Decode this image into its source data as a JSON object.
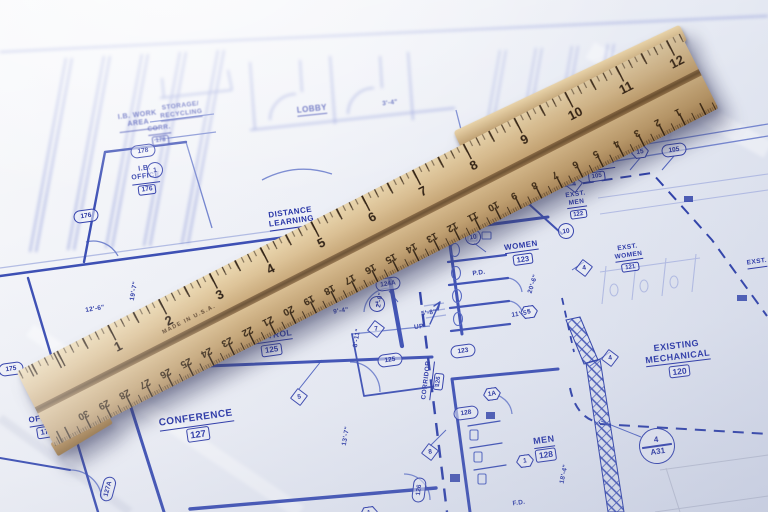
{
  "colors": {
    "paper": "#eef0f7",
    "ink": "#3b4eb4",
    "ink_dark": "#2531a0",
    "wood": "#d0b183",
    "tick": "#33220f"
  },
  "ruler": {
    "inch_numbers": [
      "1",
      "2",
      "3",
      "4",
      "5",
      "6",
      "7",
      "8",
      "9",
      "10",
      "11",
      "12"
    ],
    "cm_numbers": [
      "30",
      "29",
      "28",
      "27",
      "26",
      "25",
      "24",
      "23",
      "22",
      "21",
      "20",
      "19",
      "18",
      "17",
      "16",
      "15",
      "14",
      "13",
      "12",
      "11",
      "10",
      "9",
      "8",
      "7",
      "6",
      "5",
      "4",
      "3",
      "2",
      "1"
    ],
    "brand_text": "MADE IN U.S.A."
  },
  "blueprint": {
    "rooms": [
      {
        "name": "I.B. WORK\nAREA",
        "num": "",
        "x": 138,
        "y": 121,
        "rot": -7,
        "size": 7
      },
      {
        "name": "STORAGE/\nRECYCLING",
        "num": "",
        "x": 181,
        "y": 111,
        "rot": -7,
        "size": 6.5
      },
      {
        "name": "CORR.",
        "num": "178",
        "x": 160,
        "y": 135,
        "rot": -7,
        "size": 6.5
      },
      {
        "name": "I.B.\nOFFICE",
        "num": "176",
        "x": 146,
        "y": 180,
        "rot": -7,
        "size": 7
      },
      {
        "name": "LOBBY",
        "num": "",
        "x": 312,
        "y": 110,
        "rot": -6,
        "size": 8
      },
      {
        "name": "COATS/\nVEND.",
        "num": "",
        "x": 492,
        "y": 141,
        "rot": -8,
        "size": 6.5
      },
      {
        "name": "DISTANCE\nLEARNING",
        "num": "",
        "x": 291,
        "y": 218,
        "rot": -8,
        "size": 8
      },
      {
        "name": "VIDEO\nCONTROL",
        "num": "125",
        "x": 270,
        "y": 338,
        "rot": -8,
        "size": 8.5
      },
      {
        "name": "CONFERENCE",
        "num": "127",
        "x": 197,
        "y": 427,
        "rot": -8,
        "size": 10
      },
      {
        "name": "I.S.\nOFFICE",
        "num": "175",
        "x": 45,
        "y": 421,
        "rot": -9,
        "size": 8
      },
      {
        "name": "CORRIDOR",
        "num": "105",
        "x": 596,
        "y": 171,
        "rot": -8,
        "size": 6.5
      },
      {
        "name": "EXST.\nMEN",
        "num": "122",
        "x": 577,
        "y": 205,
        "rot": -8,
        "size": 6.5
      },
      {
        "name": "EXST.\nWOMEN",
        "num": "121",
        "x": 629,
        "y": 258,
        "rot": -8,
        "size": 6.5
      },
      {
        "name": "WOMEN",
        "num": "123",
        "x": 522,
        "y": 253,
        "rot": -8,
        "size": 8
      },
      {
        "name": "MEN",
        "num": "128",
        "x": 545,
        "y": 448,
        "rot": -8,
        "size": 9
      },
      {
        "name": "CORRIDOR",
        "num": "126",
        "x": 433,
        "y": 381,
        "rot": -83,
        "size": 6.5
      },
      {
        "name": "EXISTING\nMECHANICAL",
        "num": "120",
        "x": 678,
        "y": 359,
        "rot": -7,
        "size": 9
      },
      {
        "name": "EXST.",
        "num": "",
        "x": 757,
        "y": 263,
        "rot": -8,
        "size": 6.5
      }
    ],
    "tags": [
      {
        "shape": "oval",
        "text": "175",
        "x": 11,
        "y": 369,
        "rot": -8
      },
      {
        "shape": "oval",
        "text": "176",
        "x": 86,
        "y": 216,
        "rot": -8
      },
      {
        "shape": "oval",
        "text": "178",
        "x": 143,
        "y": 151,
        "rot": -8
      },
      {
        "shape": "oval",
        "text": "124A",
        "x": 388,
        "y": 284,
        "rot": -8
      },
      {
        "shape": "oval",
        "text": "125",
        "x": 390,
        "y": 360,
        "rot": -8
      },
      {
        "shape": "oval",
        "text": "123",
        "x": 463,
        "y": 351,
        "rot": -8
      },
      {
        "shape": "oval",
        "text": "128",
        "x": 466,
        "y": 413,
        "rot": -8
      },
      {
        "shape": "oval",
        "text": "126",
        "x": 419,
        "y": 490,
        "rot": -83
      },
      {
        "shape": "oval",
        "text": "127A",
        "x": 108,
        "y": 489,
        "rot": -75
      },
      {
        "shape": "oval",
        "text": "105",
        "x": 674,
        "y": 150,
        "rot": -8
      },
      {
        "shape": "hex",
        "text": "15",
        "x": 640,
        "y": 152,
        "rot": -8
      },
      {
        "shape": "hex",
        "text": "5",
        "x": 529,
        "y": 299,
        "rot": -8
      },
      {
        "shape": "hex",
        "text": "1A",
        "x": 492,
        "y": 368,
        "rot": -8
      },
      {
        "shape": "hex",
        "text": "1A",
        "x": 294,
        "y": 486,
        "rot": -8
      },
      {
        "shape": "hex",
        "text": "1",
        "x": 369,
        "y": 461,
        "rot": -8
      },
      {
        "shape": "hex",
        "text": "1",
        "x": 525,
        "y": 396,
        "rot": -8
      },
      {
        "shape": "circle",
        "text": "1",
        "x": 146,
        "y": 390,
        "rot": -8
      },
      {
        "shape": "circle",
        "text": "1",
        "x": 155,
        "y": 170,
        "rot": -8
      },
      {
        "shape": "circle",
        "text": "7",
        "x": 377,
        "y": 304,
        "rot": -8
      },
      {
        "shape": "circle",
        "text": "10",
        "x": 473,
        "y": 237,
        "rot": -8
      },
      {
        "shape": "circle",
        "text": "10",
        "x": 566,
        "y": 231,
        "rot": -8
      },
      {
        "shape": "diamond",
        "text": "7",
        "x": 376,
        "y": 329,
        "rot": -8
      },
      {
        "shape": "diamond",
        "text": "5",
        "x": 299,
        "y": 397,
        "rot": -8
      },
      {
        "shape": "diamond",
        "text": "8",
        "x": 430,
        "y": 452,
        "rot": -8
      },
      {
        "shape": "diamond",
        "text": "4",
        "x": 574,
        "y": 184,
        "rot": -8
      },
      {
        "shape": "diamond",
        "text": "4",
        "x": 584,
        "y": 268,
        "rot": -8
      },
      {
        "shape": "diamond",
        "text": "4",
        "x": 610,
        "y": 358,
        "rot": -8
      }
    ],
    "dims": [
      {
        "text": "12'-6\"",
        "x": 95,
        "y": 309,
        "rot": -9
      },
      {
        "text": "19'-7\"",
        "x": 134,
        "y": 291,
        "rot": -80
      },
      {
        "text": "14'-9\"",
        "x": 77,
        "y": 428,
        "rot": -75
      },
      {
        "text": "3'-4\"",
        "x": 390,
        "y": 103,
        "rot": -7
      },
      {
        "text": "9'-4\"",
        "x": 341,
        "y": 311,
        "rot": -8
      },
      {
        "text": "5'-8\"",
        "x": 429,
        "y": 313,
        "rot": -8
      },
      {
        "text": "11'-5\"",
        "x": 521,
        "y": 314,
        "rot": -8
      },
      {
        "text": "2'-0\"",
        "x": 380,
        "y": 300,
        "rot": -80
      },
      {
        "text": "8'-11\"",
        "x": 357,
        "y": 338,
        "rot": -80
      },
      {
        "text": "13'-7\"",
        "x": 346,
        "y": 436,
        "rot": -80
      },
      {
        "text": "20'-6\"",
        "x": 533,
        "y": 284,
        "rot": -72
      },
      {
        "text": "18'-4\"",
        "x": 564,
        "y": 474,
        "rot": -78
      },
      {
        "text": "UP",
        "x": 419,
        "y": 327,
        "rot": -8
      },
      {
        "text": "P.D.",
        "x": 479,
        "y": 273,
        "rot": -8
      },
      {
        "text": "F.D.",
        "x": 519,
        "y": 503,
        "rot": -8
      }
    ],
    "detail": {
      "top": "4",
      "bottom": "A31"
    }
  }
}
